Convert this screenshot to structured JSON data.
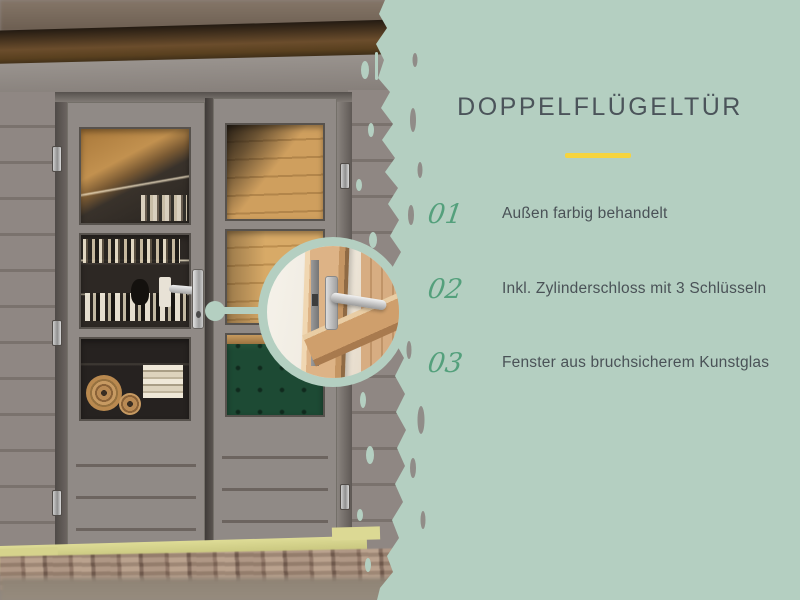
{
  "panel": {
    "title": "DOPPELFLÜGELTÜR",
    "features": [
      {
        "number": "01",
        "label": "Außen farbig behandelt"
      },
      {
        "number": "02",
        "label": "Inkl. Zylinderschloss mit 3 Schlüsseln"
      },
      {
        "number": "03",
        "label": "Fenster aus bruchsicherem Kunstglas"
      }
    ]
  },
  "theme": {
    "panel_background": "#b4cfc1",
    "divider_yellow": "#f6d43e",
    "number_green": "#54a07c",
    "text_color": "#4a5257",
    "door_gray": "#908a86",
    "sofa_green": "#1d4a34"
  }
}
